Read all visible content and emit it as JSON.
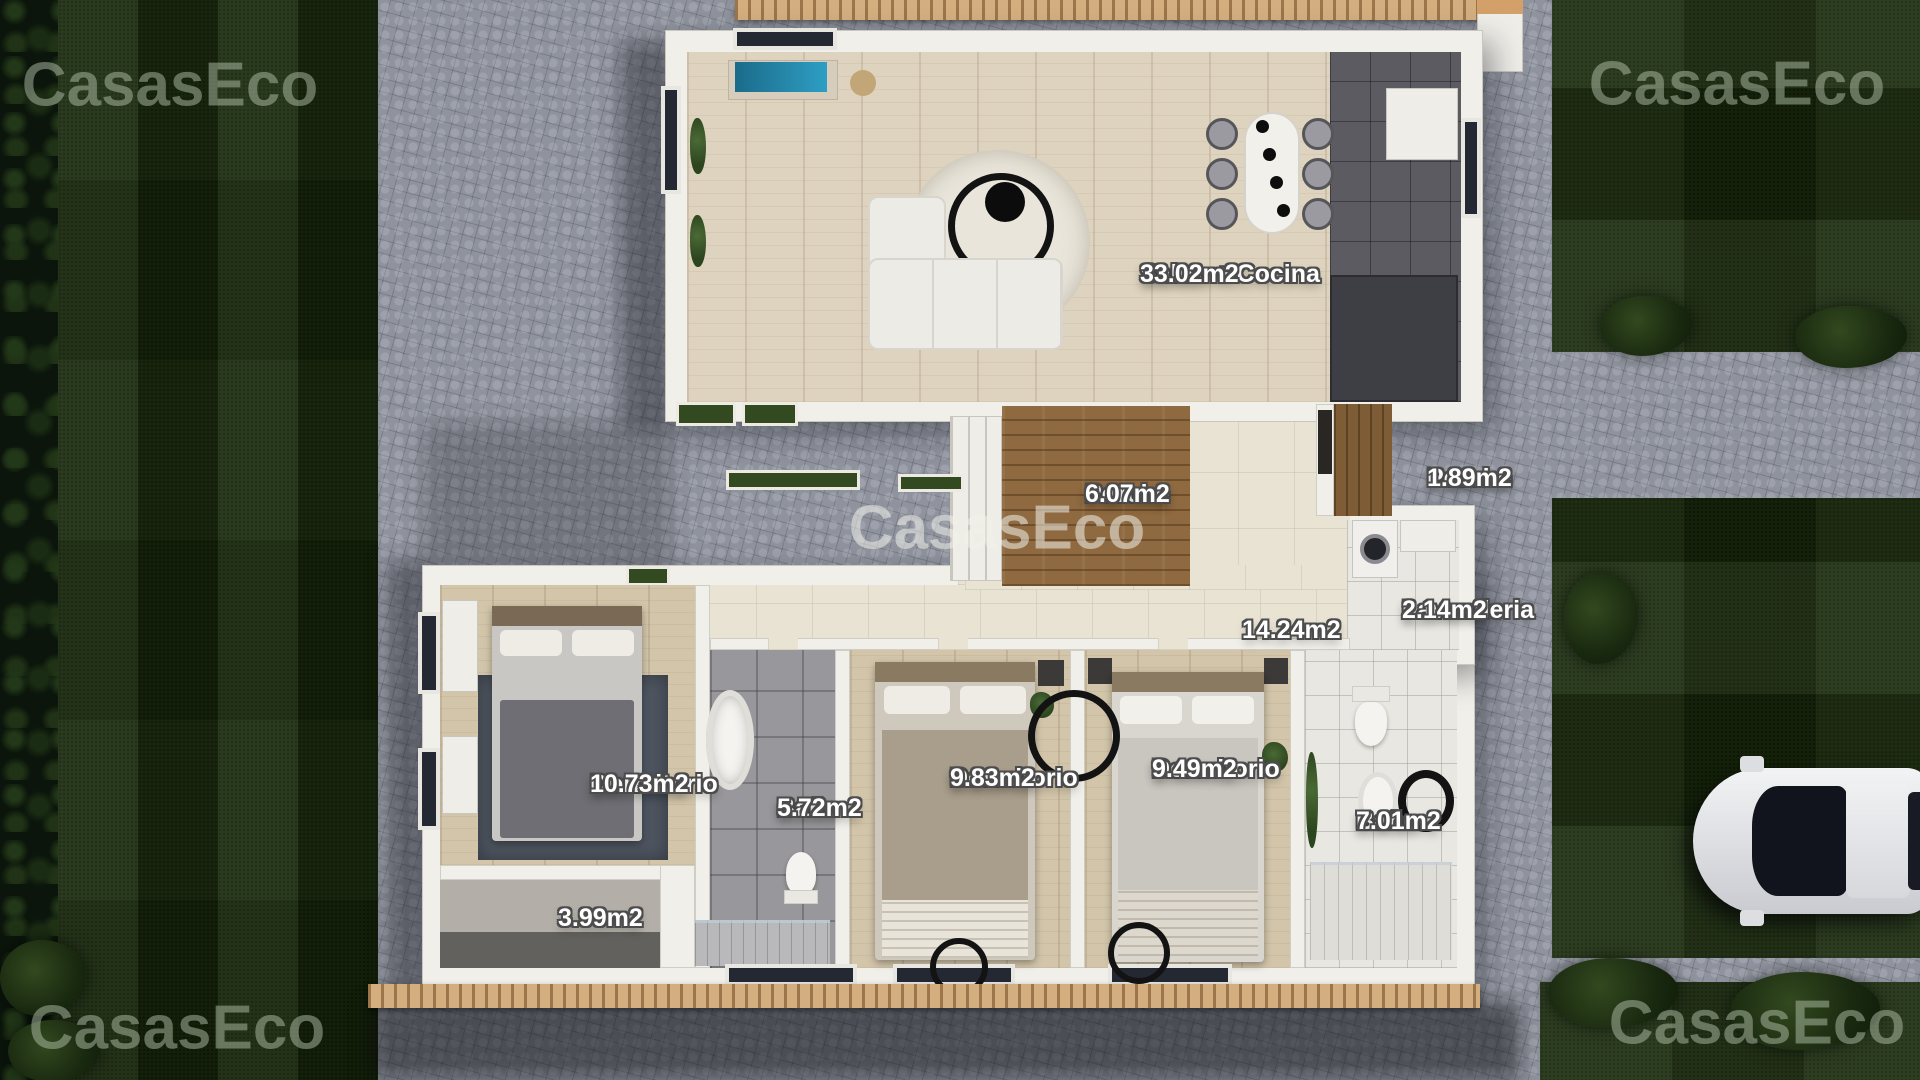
{
  "brand": {
    "watermark_text": "CasasEco"
  },
  "plan": {
    "rooms": [
      {
        "id": "salon-cocina",
        "name": "Salon + Cocina",
        "area": "33.02m2"
      },
      {
        "id": "porche-main",
        "name": "Porche",
        "area": "6.07m2"
      },
      {
        "id": "porche-side",
        "name": "Porche",
        "area": "1.89m2"
      },
      {
        "id": "lavanderia",
        "name": "Lavanderia",
        "area": "2.14m2"
      },
      {
        "id": "pasillo",
        "name": "",
        "area": "14.24m2"
      },
      {
        "id": "dormitorio-1",
        "name": "Dormitorio",
        "area": "10.73m2"
      },
      {
        "id": "bano-1",
        "name": "Baño",
        "area": "5.72m2"
      },
      {
        "id": "dormitorio-2",
        "name": "Dormitorio",
        "area": "9.83m2"
      },
      {
        "id": "dormitorio-3",
        "name": "Dormitorio",
        "area": "9.49m2"
      },
      {
        "id": "bano-2",
        "name": "Baño",
        "area": "7.01m2"
      },
      {
        "id": "terraza",
        "name": "",
        "area": "3.99m2"
      }
    ]
  },
  "colors": {
    "grass": "#1d2f0e",
    "cobblestone": "#8f939d",
    "deck_wood": "#8f6a40",
    "interior_wood": "#ddd3be",
    "wall_white": "#f1efe9",
    "label_text": "#ffffff",
    "label_outline": "#4c4c4c",
    "watermark_on_grass": "rgba(178,191,170,0.5)",
    "watermark_on_paving": "rgba(240,240,234,0.55)"
  }
}
